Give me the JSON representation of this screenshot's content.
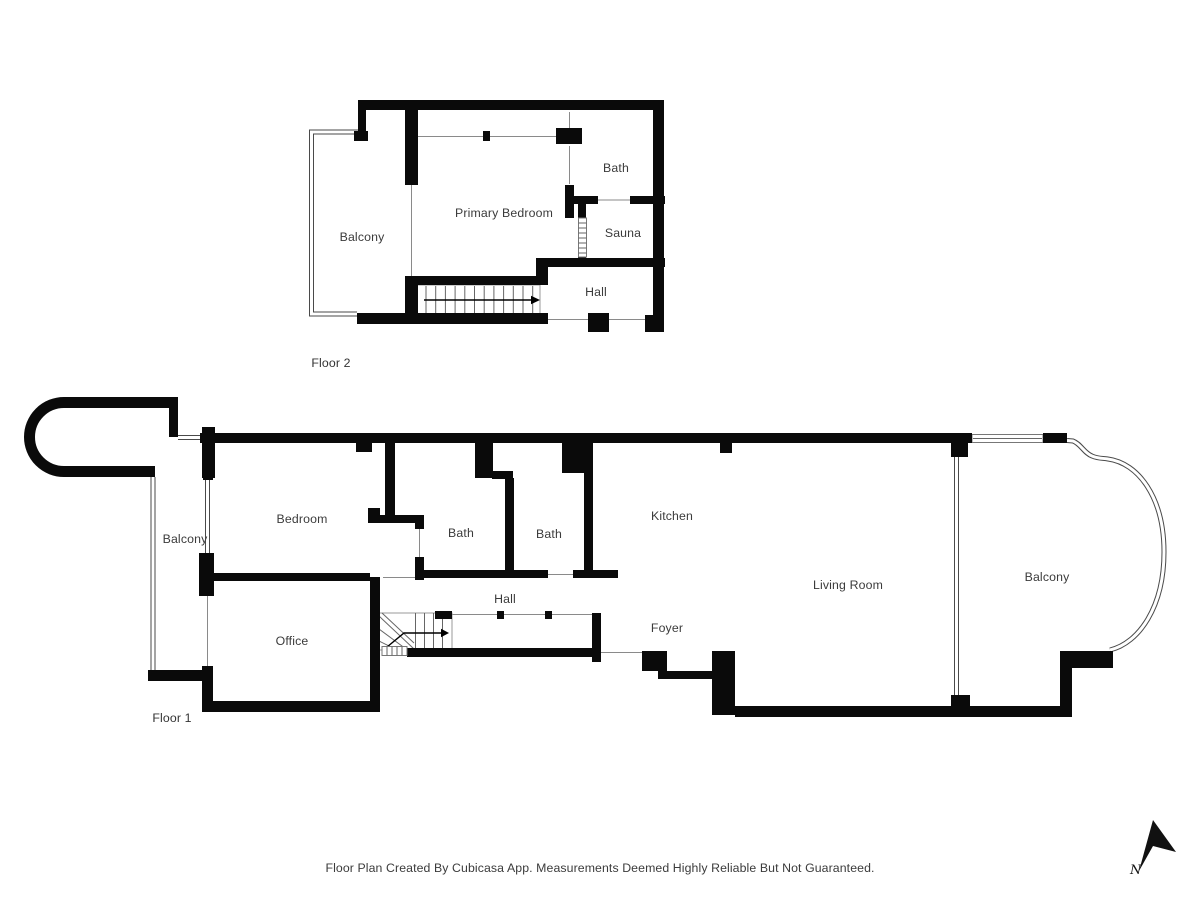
{
  "title": "Floor Plan",
  "colors": {
    "wall": "#0a0a0a",
    "background": "#ffffff",
    "thin_line": "#8a8a8a",
    "label_text": "#3b3b3b"
  },
  "floors": [
    {
      "label": "Floor 2",
      "rooms": [
        {
          "name": "Balcony"
        },
        {
          "name": "Primary Bedroom"
        },
        {
          "name": "Bath"
        },
        {
          "name": "Sauna"
        },
        {
          "name": "Hall"
        }
      ]
    },
    {
      "label": "Floor 1",
      "rooms": [
        {
          "name": "Balcony"
        },
        {
          "name": "Bedroom"
        },
        {
          "name": "Bath"
        },
        {
          "name": "Bath"
        },
        {
          "name": "Kitchen"
        },
        {
          "name": "Hall"
        },
        {
          "name": "Office"
        },
        {
          "name": "Foyer"
        },
        {
          "name": "Living Room"
        },
        {
          "name": "Balcony"
        }
      ]
    }
  ],
  "compass": {
    "north_label": "N"
  },
  "footer": {
    "disclaimer": "Floor Plan Created By Cubicasa App. Measurements Deemed Highly Reliable But Not Guaranteed."
  }
}
